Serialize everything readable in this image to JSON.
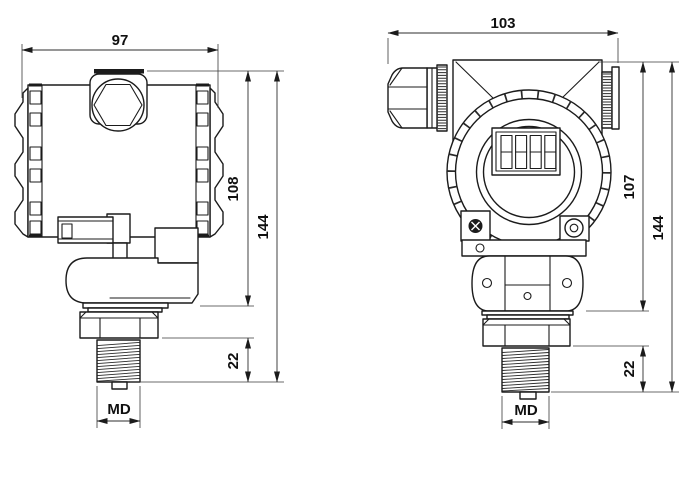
{
  "drawing": {
    "colors": {
      "background": "#ffffff",
      "line": "#1b1b1b",
      "dimension": "#2e2e2e"
    },
    "lcd": {
      "digit_cells": 4
    },
    "views": {
      "side": {
        "dims": {
          "width": "97",
          "body_height": "108",
          "total_height": "144",
          "thread_length": "22",
          "thread_diameter": "MD"
        }
      },
      "front": {
        "dims": {
          "width": "103",
          "body_height": "107",
          "total_height": "144",
          "thread_length": "22",
          "thread_diameter": "MD"
        }
      }
    }
  }
}
